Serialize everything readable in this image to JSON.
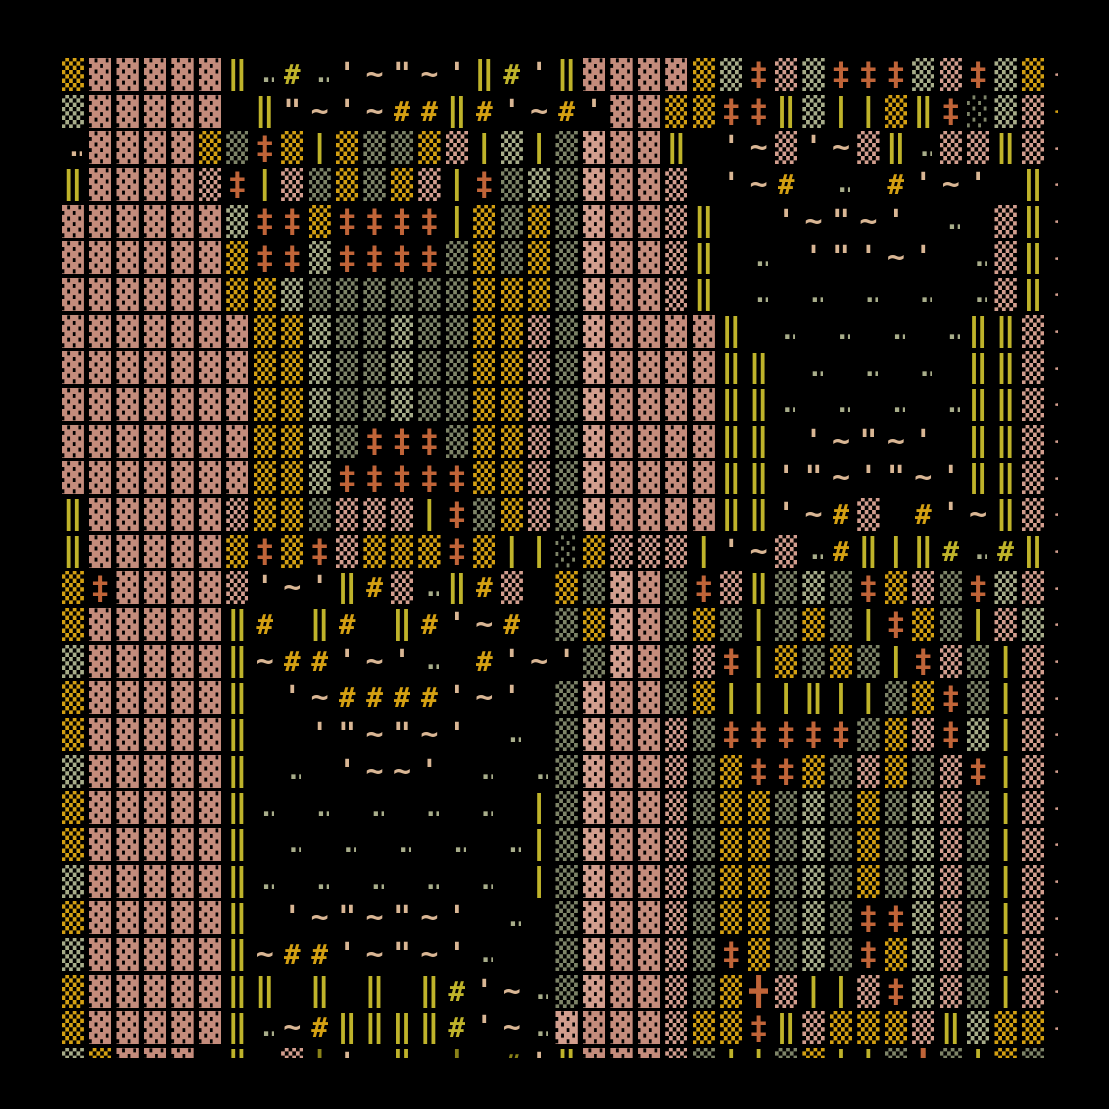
{
  "artwork": {
    "type": "ascii-textile-generative-art",
    "background": "#000000",
    "palette": {
      "k": "#c48c7c",
      "K": "#d29e8e",
      "g": "#d4a012",
      "s": "#a8ad8a",
      "d": "#7e8468",
      "y": "#bfb32a",
      "Y": "#8a8218",
      "o": "#c06438",
      "t": "#d9b694"
    },
    "glyphs": {
      "3": "▓",
      "2": "▒",
      "1": "░",
      "D": "‖",
      "l": "|",
      "X": "‡",
      "+": "╋",
      "#": "#",
      "~": "~",
      "q": "'",
      "Q": "\"",
      ".": ".",
      ":": "..",
      "{": "{",
      "_": ""
    },
    "grid": {
      "cols": 37,
      "rows": 28,
      "cell_w": 27.45,
      "cell_h": 36.68,
      "rows_tokens": [
        "2g 3k 3k 3k 3k 3k Dy :s #y :s qt ~t Qt ~t qt Dy #y qt Dy 3k 3k 3k 3k 2g 2s Xo 2K 2s Xo Xo Xo 2s 2K Xo 2s 2g {K",
        "2s 3k 3k 3k 3k 3k __ Dy Qt ~t qt ~t #g #g Dy #g qt ~t #g qt 3k 3k 2g 2g Xo Xo Dy 2s ly ly 2g Dy Xo 1d 2s 2K {g",
        ":t 3k 3k 3k 3k 2g 2d Xo 2g ly 2g 2d 2d 2g 2K ly 2s ly 2d 3K 3k 3k Dy __ qt ~t 2K qt ~t 2K Dy :s 2K 2K Dy 2K {K",
        "Dy 3k 3k 3k 3k 2K Xo ly 2K 2d 2g 2d 2g 2K ly Xo 2d 2s 2d 3K 3k 3k 2K __ qt ~t #g __ :s __ #g qt ~t qt __ Dy {K",
        "3k 3k 3k 3k 3k 3k 2s Xo Xo 2g Xo Xo Xo Xo ly 2g 2d 2g 2d 3K 3k 3k 2K Dy __ __ qt ~t Qt ~t qt __ :s __ 2K Dy {K",
        "3k 3k 3k 3k 3k 3k 2g Xo Xo 2s Xo Xo Xo Xo 2d 2g 2d 2g 2d 3K 3k 3k 2K Dy __ :s __ qt Qt qt ~t qt __ :s 2K Dy {K",
        "3k 3k 3k 3k 3k 3k 2g 2g 2s 2d 2d 2d 2d 2d 2d 2g 2g 2g 2d 3K 3k 3k 2K Dy __ :s __ :s __ :s __ :s __ :s 2K Dy {K",
        "3k 3k 3k 3k 3k 3k 3k 2g 2g 2s 2d 2d 2s 2d 2d 2g 2g 2K 2d 3K 3k 3k 3k 3k Dy __ :s __ :s __ :s __ :s Dy Dy 2K {K",
        "3k 3k 3k 3k 3k 3k 3k 2g 2g 2s 2d 2d 2s 2d 2d 2g 2g 2K 2d 3K 3k 3k 3k 3k Dy Dy __ :s __ :s __ :s __ Dy Dy 2K {K",
        "3k 3k 3k 3k 3k 3k 3k 2g 2g 2s 2d 2d 2s 2d 2d 2g 2g 2K 2d 3K 3k 3k 3k 3k Dy Dy :s __ :s __ :s __ :s Dy Dy 2K {K",
        "3k 3k 3k 3k 3k 3k 3k 2g 2g 2s 2d Xo Xo Xo 2d 2g 2g 2K 2d 3K 3k 3k 3k 3k Dy Dy __ qt ~t Qt ~t qt __ Dy Dy 2K {K",
        "3k 3k 3k 3k 3k 3k 3k 2g 2g 2s Xo Xo Xo Xo Xo 2g 2g 2K 2d 3K 3k 3k 3k 3k Dy Dy qt Qt ~t qt Qt ~t qt Dy Dy 2K {K",
        "Dy 3k 3k 3k 3k 3k 2K 2g 2g 2d 2K 2K 2K ly Xo 2d 2g 2K 2d 3K 3k 3k 3k 3k Dy Dy qt ~t #g 2K __ #g qt ~t Dy 2K {K",
        "Dy 3k 3k 3k 3k 3k 2g Xo 2g Xo 2K 2g 2g 2g Xo 2g ly ly 1d 2g 2K 2K 2K ly qt ~t 2K :s #g Dy ly Dy #y :s #y Dy {K",
        "2g Xo 3k 3k 3k 3k 2K qt ~t qt Dy #g 2K :s Dy #g 2K __ 2g 2d 3K 3k 2d Xo 2K Dy 2d 2s 2d Xo 2g 2K 2d Xo 2s 2K {K",
        "2g 3k 3k 3k 3k 3k Dy #g __ Dy #g __ Dy #g qt ~t #g __ 2d 2g 3K 3k 2d 2g 2d ly 2d 2g 2d ly Xo 2g 2d ly 2K 2s {K",
        "2s 3k 3k 3k 3k 3k Dy ~t #g #g qt ~t qt :s __ #g qt ~t qt 2d 3K 3k 2d 2K Xo ly 2g 2d 2g 2d ly Xo 2K 2d ly 2K {K",
        "2g 3k 3k 3k 3k 3k Dy __ qt ~t #g #g #g #g qt ~t qt __ 2d 3K 3k 3k 2d 2g ly ly ly Dy ly ly 2d 2g Xo 2d ly 2K {K",
        "2g 3k 3k 3k 3k 3k Dy __ __ qt Qt ~t Qt ~t qt __ :s __ 2d 3K 3k 3k 2K 2d Xo Xo Xo Xo Xo 2d 2g 2K Xo 2s ly 2K {K",
        "2s 3k 3k 3k 3k 3k Dy __ :s __ qt ~t ~t qt __ :s __ :s 2d 3K 3k 3k 2K 2d 2g Xo Xo 2g 2d 2K 2g 2d 2K Xo ly 2K {K",
        "2g 3k 3k 3k 3k 3k Dy :s __ :s __ :s __ :s __ :s __ ly 2d 3K 3k 3k 2K 2d 2g 2g 2d 2s 2d 2g 2d 2s 2K 2d ly 2K {K",
        "2g 3k 3k 3k 3k 3k Dy __ :s __ :s __ :s __ :s __ :s ly 2d 3K 3k 3k 2K 2d 2g 2g 2d 2s 2d 2g 2d 2s 2K 2d ly 2K {K",
        "2s 3k 3k 3k 3k 3k Dy :s __ :s __ :s __ :s __ :s __ ly 2d 3K 3k 3k 2K 2d 2g 2g 2d 2s 2d 2g 2d 2s 2K 2d ly 2K {K",
        "2g 3k 3k 3k 3k 3k Dy __ qt ~t Qt ~t Qt ~t qt __ :s __ 2d 3K 3k 3k 2K 2d 2g 2g 2d 2s 2d Xo Xo 2s 2K 2d ly 2K {K",
        "2s 3k 3k 3k 3k 3k Dy ~t #g #g qt ~t Qt ~t qt :s __ __ 2d 3K 3k 3k 2K 2d Xo 2g 2d 2s 2d Xo 2g 2s 2K 2d ly 2K {K",
        "2g 3k 3k 3k 3k 3k Dy Dy __ Dy __ Dy __ Dy #y qt ~t :s 2d 3K 3k 3k 2K 2d 2g +o 2K ly ly 2K Xo 2s 2K 2d ly 2K {K",
        "2g 3k 3k 3k 3k 3k Dy :s ~t #g Dy Dy Dy Dy #y qt ~t :s 3K 3k 3k 3k 2K 2g 2g Xo Dy 2K 2g 2g 2g 2K Dy 2s 2g 2g {K",
        "2s 2g 3k 3k 3k __ Dy __ 2K lY qt __ Dy __ lY __ #Y qt Dy 3k 3k 3k 2K 2d ly ly 2d 2g ly ly 2d +o 2d ly 2g 2d {K"
      ]
    }
  }
}
